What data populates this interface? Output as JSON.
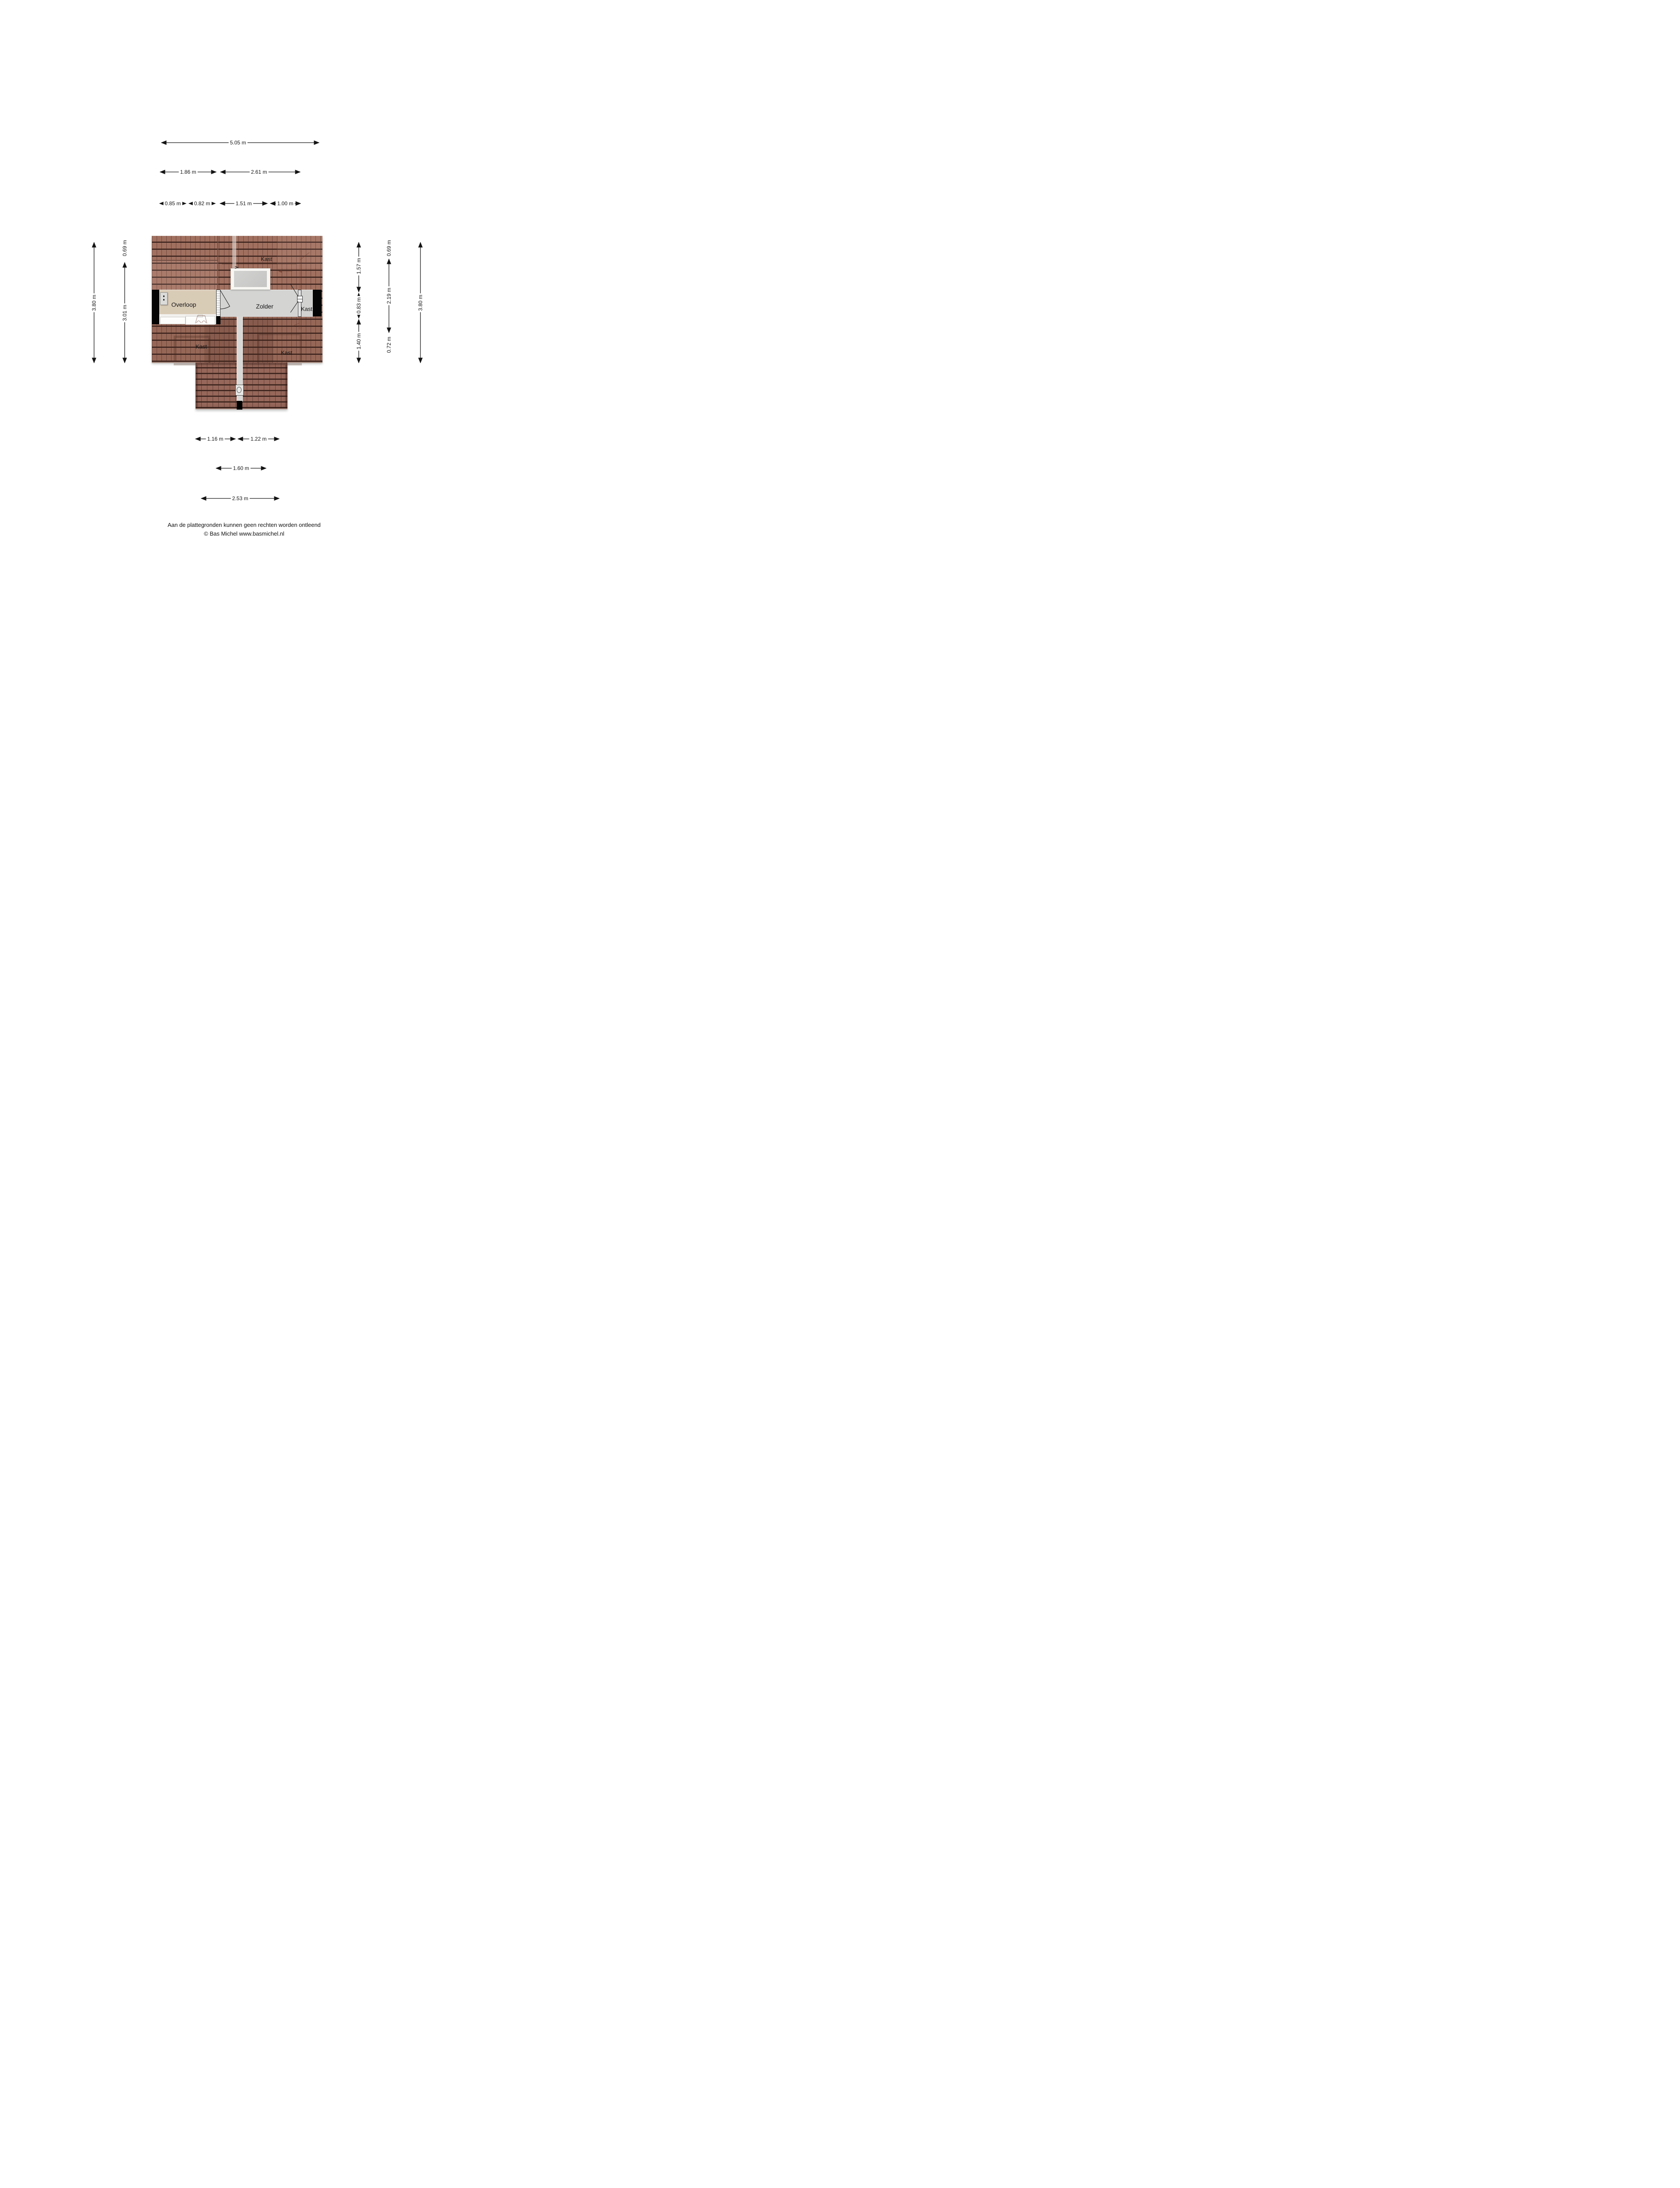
{
  "dimensions": {
    "top": [
      "5.05 m",
      "1.86 m",
      "2.61 m",
      "0.85 m",
      "0.82 m",
      "1.51 m",
      "1.00 m"
    ],
    "left": [
      "3.80 m",
      "0.69 m",
      "3.01 m"
    ],
    "right": [
      "1.57 m",
      "0.83 m",
      "1.40 m",
      "0.69 m",
      "2.19 m",
      "0.72 m",
      "3.80 m"
    ],
    "bottom": [
      "1.16 m",
      "1.22 m",
      "1.60 m",
      "2.53 m"
    ]
  },
  "rooms": {
    "kast_top": "Kast",
    "overloop": "Overloop",
    "zolder": "Zolder",
    "kast_right": "Kast",
    "kast_bottom_left": "Kast",
    "kast_bottom_right": "Kast"
  },
  "footer": {
    "line1": "Aan de plattegronden kunnen geen rechten worden ontleend",
    "line2": "© Bas Michel www.basmichel.nl"
  },
  "colors": {
    "roof_base": "#a1705f",
    "roof_line": "#3a231d",
    "floor_overloop": "#d9ccb7",
    "floor_zolder": "#d4d4d3",
    "wall_black": "#050505",
    "background": "#ffffff"
  }
}
